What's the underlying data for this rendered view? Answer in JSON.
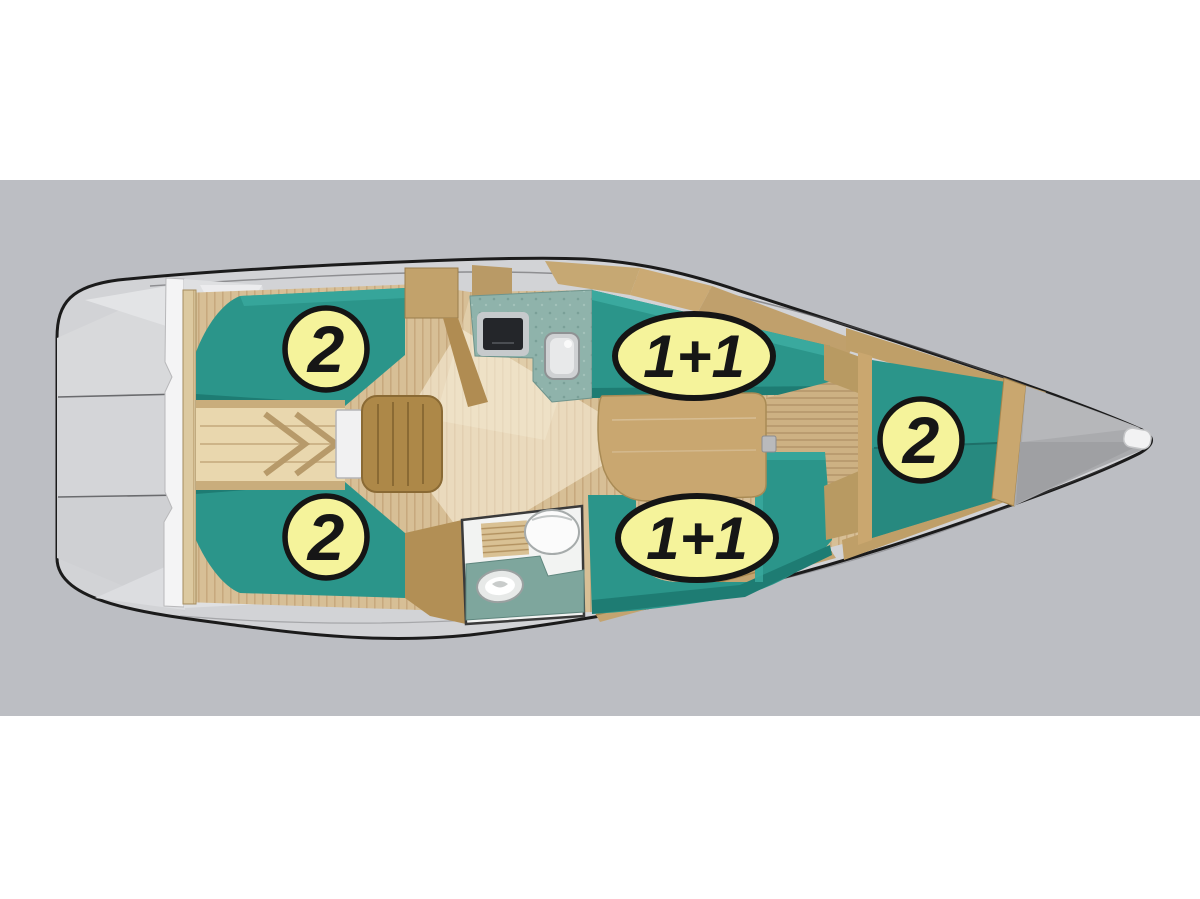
{
  "page": {
    "kind": "boat-interior-layout-plan",
    "view": "top-down",
    "background_color": "#ffffff",
    "band_color": "#bcbec3"
  },
  "diagram": {
    "hull_colors": {
      "outline": "#1b1b1b",
      "deck_gray": "#d2d3d6",
      "cockpit_seat": "#dfe0e2",
      "bow_deck": "#aaabae"
    },
    "interior_colors": {
      "cushion_teal": "#2b958a",
      "cushion_teal_dark": "#1e7c73",
      "floor_wood": "#d7bf96",
      "trim_wood": "#c2a26b",
      "steps_wood": "#ad8848",
      "engine_box_wood": "#e9d7ae",
      "galley_counter": "#8fb3ab",
      "head_floor": "#f2f3f2",
      "stove_black": "#24262a"
    },
    "marker_style": {
      "fill": "#f5f39b",
      "stroke": "#151515",
      "text_color": "#161616"
    },
    "berth_markers": [
      {
        "area": "aft-cabin-port-berth",
        "shape": "circle",
        "label": "2"
      },
      {
        "area": "saloon-starboard-settee",
        "shape": "ellipse",
        "label": "1+1"
      },
      {
        "area": "aft-cabin-starboard-berth",
        "shape": "circle",
        "label": "2"
      },
      {
        "area": "saloon-port-settee",
        "shape": "ellipse",
        "label": "1+1"
      },
      {
        "area": "forward-v-berth",
        "shape": "circle",
        "label": "2"
      }
    ]
  }
}
